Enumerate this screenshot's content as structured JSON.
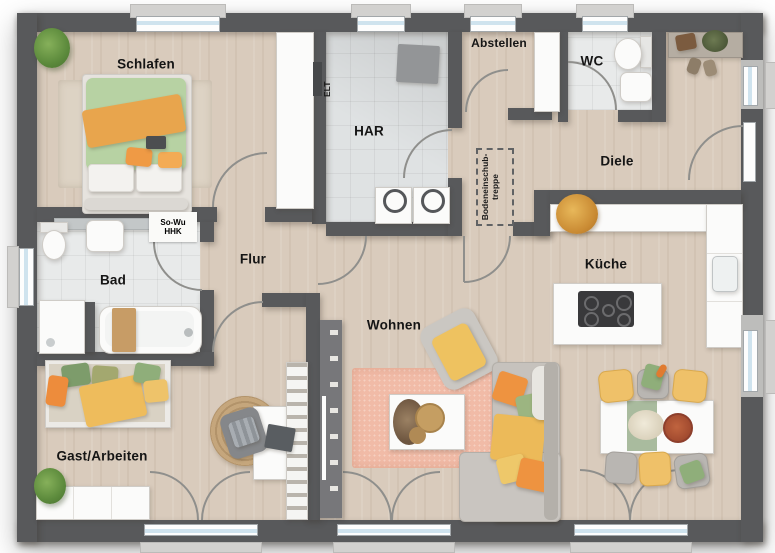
{
  "rooms": {
    "schlafen": {
      "label": "Schlafen"
    },
    "har": {
      "label": "HAR"
    },
    "abstellen": {
      "label": "Abstellen"
    },
    "wc": {
      "label": "WC"
    },
    "diele": {
      "label": "Diele"
    },
    "bad": {
      "label": "Bad"
    },
    "flur": {
      "label": "Flur"
    },
    "kueche": {
      "label": "Küche"
    },
    "wohnen": {
      "label": "Wohnen"
    },
    "gast": {
      "label": "Gast/Arbeiten"
    }
  },
  "annotations": {
    "elt": "ELT",
    "heating_line1": "So-Wu",
    "heating_line2": "HHK",
    "attic_line1": "Bodeneinschub-",
    "attic_line2": "treppe"
  },
  "colors": {
    "wall": "#58595b",
    "wood": "#d9cbbc",
    "tile": "#e8eaea",
    "tile_har": "#dfe2e3",
    "rug_salmon": "#f1bba7",
    "rug_beige": "#ddd3c4",
    "rug_jute": "#c5a67c",
    "furniture_white": "#fbfbfa",
    "sofa_gray": "#c6c2bd",
    "accent_yellow": "#efc169",
    "accent_orange": "#ee9340",
    "accent_green": "#9cb581",
    "bedding_green": "#b7d2a3",
    "blanket_orange": "#e8a54d",
    "glass_blue": "#cfe3ee",
    "sill_gray": "#d2d1cf",
    "arc_gray": "#8f8f8c"
  }
}
